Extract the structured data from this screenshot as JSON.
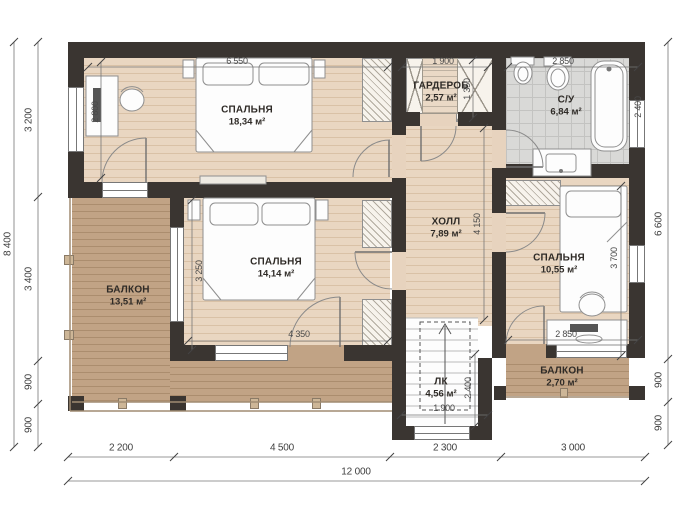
{
  "rooms": {
    "bedroom_main": {
      "name": "СПАЛЬНЯ",
      "area": "18,34 м²"
    },
    "wardrobe": {
      "name": "ГАРДЕРОБ",
      "area": "2,57 м²"
    },
    "bathroom": {
      "name": "С/У",
      "area": "6,84 м²"
    },
    "hall": {
      "name": "ХОЛЛ",
      "area": "7,89 м²"
    },
    "bedroom_middle": {
      "name": "СПАЛЬНЯ",
      "area": "14,14 м²"
    },
    "bedroom_right": {
      "name": "СПАЛЬНЯ",
      "area": "10,55 м²"
    },
    "balcony_left": {
      "name": "БАЛКОН",
      "area": "13,51 м²"
    },
    "balcony_right": {
      "name": "БАЛКОН",
      "area": "2,70 м²"
    },
    "stairs": {
      "name": "ЛК",
      "area": "4,56 м²"
    }
  },
  "dims": {
    "left_total": "8 400",
    "left": [
      "3 200",
      "3 400",
      "900",
      "900"
    ],
    "right": [
      "6 600",
      "900",
      "900"
    ],
    "bottom": [
      "2 200",
      "4 500",
      "2 300",
      "3 000"
    ],
    "bottom_total": "12 000",
    "inner": {
      "bed_main_width": "6 550",
      "bed_main_left": "2 800",
      "wardrobe_w": "1 900",
      "wardrobe_d": "1 350",
      "bath_w": "2 850",
      "bath_tub": "2 400",
      "hall_h": "4 150",
      "balcony_window": "3 250",
      "bed_mid_w": "4 350",
      "bed_right_bed": "3 700",
      "bed_right_w": "2 850",
      "stairs_w": "1 900",
      "stairs_h": "2 400"
    }
  },
  "colors": {
    "wall": "#3a3531",
    "wood_floor": "#e9d6c1",
    "balcony_floor": "#c1a385",
    "tile_floor": "#d9d9d7",
    "dim_text": "#4a4a4a"
  }
}
